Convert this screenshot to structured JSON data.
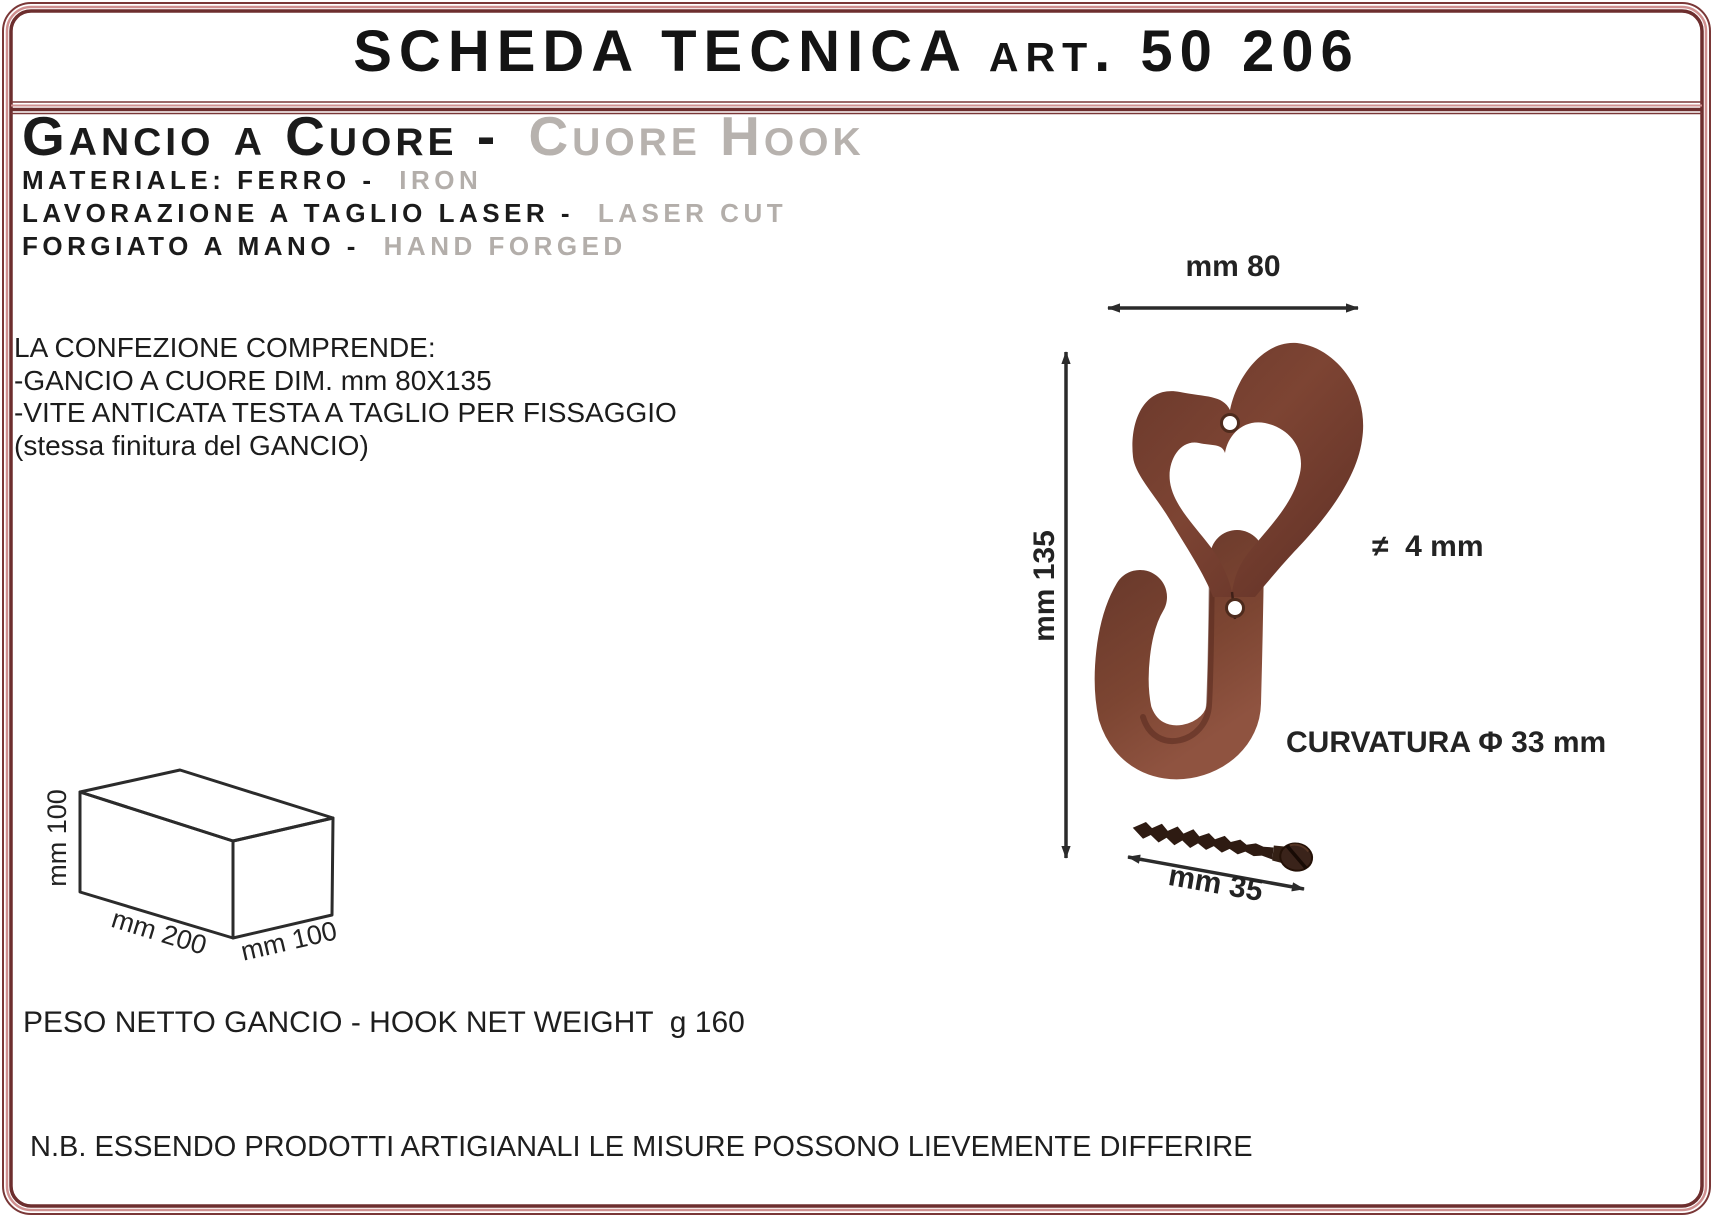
{
  "header": {
    "title": "SCHEDA TECNICA art. 50 206"
  },
  "product": {
    "title_it": "Gancio a Cuore -",
    "title_en": "Cuore Hook",
    "specs": [
      {
        "it": "MATERIALE: FERRO -",
        "en": "IRON"
      },
      {
        "it": "LAVORAZIONE A TAGLIO LASER -",
        "en": "LASER CUT"
      },
      {
        "it": "FORGIATO A MANO -",
        "en": "HAND FORGED"
      }
    ]
  },
  "package": {
    "line1": "LA CONFEZIONE COMPRENDE:",
    "line2": "-GANCIO A CUORE DIM. mm 80X135",
    "line3": "-VITE ANTICATA TESTA A TAGLIO PER FISSAGGIO",
    "line4": "(stessa finitura del GANCIO)"
  },
  "drawing": {
    "width_label": "mm 80",
    "height_label": "mm 135",
    "thickness_label": "≠  4 mm",
    "curvature_label": "CURVATURA Φ 33 mm",
    "screw_length_label": "mm 35"
  },
  "box_diagram": {
    "height_label": "mm 100",
    "length_label": "mm 200",
    "depth_label": "mm 100"
  },
  "weight_line": "PESO NETTO GANCIO - HOOK NET WEIGHT  g 160",
  "note_line": "N.B. ESSENDO PRODOTTI ARTIGIANALI LE MISURE POSSONO LIEVEMENTE DIFFERIRE",
  "colors": {
    "frame_dark": "#6d2e2e",
    "frame_mid": "#7a3737",
    "frame_light": "#cf9090",
    "text_primary": "#1b1b1b",
    "text_muted": "#b5b0ac",
    "hook_rust": "#7b4331",
    "screw_brown": "#2e1b12",
    "drawing_line": "#2b2b2b"
  }
}
